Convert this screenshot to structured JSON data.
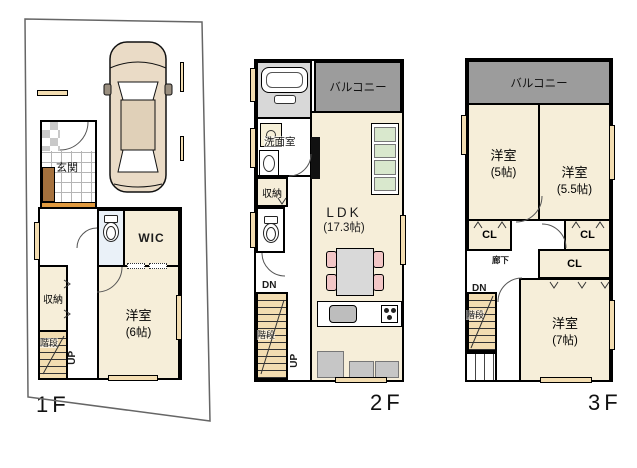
{
  "floor1": {
    "label": "1F",
    "entrance": "玄関",
    "wic": "WIC",
    "storage": "収納",
    "stairs": "階段",
    "up": "UP",
    "bedroom": {
      "name": "洋室",
      "size": "(6帖)"
    }
  },
  "floor2": {
    "label": "2F",
    "balcony": "バルコニー",
    "washroom": "洗面室",
    "storage": "収納",
    "dn": "DN",
    "stairs": "階段",
    "up": "UP",
    "ldk": {
      "name": "LDK",
      "size": "(17.3帖)"
    }
  },
  "floor3": {
    "label": "3F",
    "balcony": "バルコニー",
    "bedroom5": {
      "name": "洋室",
      "size": "(5帖)"
    },
    "bedroom55": {
      "name": "洋室",
      "size": "(5.5帖)"
    },
    "bedroom7": {
      "name": "洋室",
      "size": "(7帖)"
    },
    "closets": {
      "left": "CL",
      "right": "CL",
      "middle": "CL"
    },
    "corridor": "廊下",
    "dn": "DN",
    "stairs": "階段"
  },
  "colors": {
    "room_floor": "#f6eed9",
    "balcony": "#9c9c9c",
    "stairs_floor": "#f3ddb1",
    "window_beige": "#f3ddb1",
    "tile_checker": "#c9c9c9",
    "wood_cabinet": "#a5713d",
    "entry_step": "#e09a40",
    "chair_pink": "#f2c6c6",
    "cabinet_green": "#d9e8cd",
    "furniture_gray": "#c6c6c6",
    "bath_floor": "#d8d8d8",
    "toilet_floor": "#eaf1f8",
    "wall": "#000000"
  }
}
